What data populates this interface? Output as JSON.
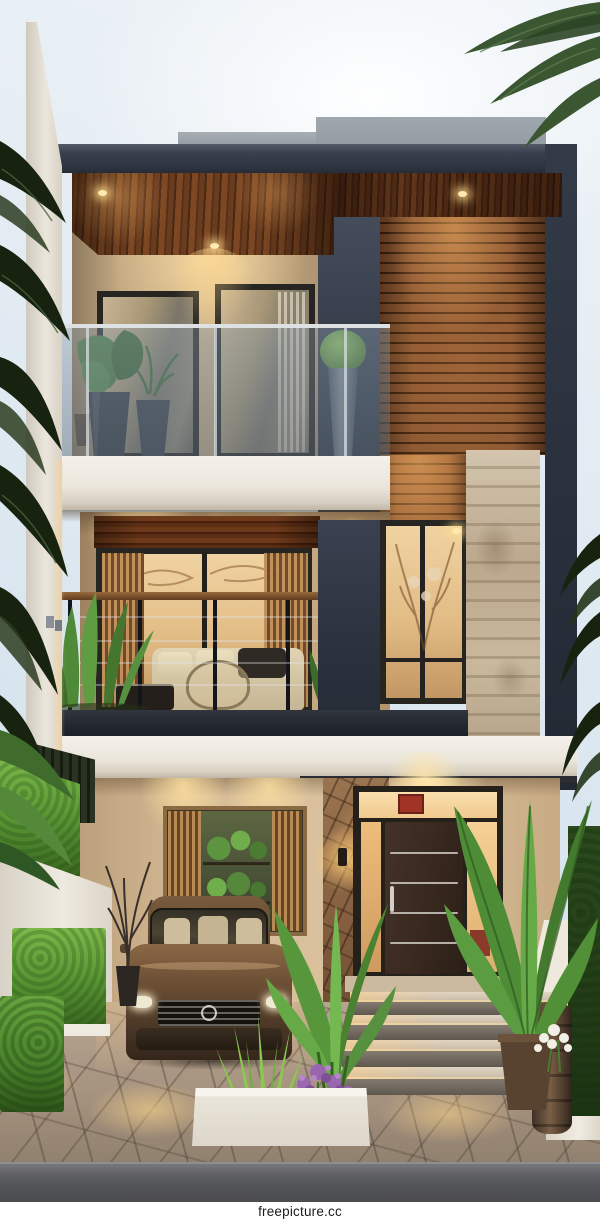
{
  "watermark": {
    "text": "freepicture.cc"
  },
  "scene": {
    "type": "architectural-photo",
    "time_of_day": "dusk with warm interior lighting",
    "description": "Modern minimalist three-story tropical house: dark flat roof fascia over a wood-plank soffit with downlights, glass-railed balcony with potted plants, horizontal wood-slat accent wall, travertine stone column, second-floor balcony with sofa and cable railing, tall warm-lit bedroom window, carport with a bronze sedan, plant-filled display window, stone entry pillar with sconce, dark wood entry door with steel inlays, lit entry steps, hedges, tropical plants, purple flowers, white planters, flagstone driveway and palms framing a pale sky.",
    "palette": {
      "sky": "#e3ecf3",
      "roof_fascia": "#39414d",
      "ceiling_wood": "#6a3c1d",
      "slat_wood": "#8a5632",
      "facade_beige": "#d8c19e",
      "dark_panel": "#363d4b",
      "stone_column": "#c4b59e",
      "entry_stone": "#8a6343",
      "white_slab": "#eceade",
      "interior_glow": "#f3cf97",
      "door_brown": "#3b2b21",
      "car_bronze": "#6e5138",
      "foliage_dark": "#17220f",
      "foliage_bright": "#6fae3f",
      "flower_purple": "#9a66b0",
      "paving": "#a89685",
      "road": "#55565a"
    },
    "elements": [
      "sky",
      "palm fronds",
      "rooftop boxes",
      "dark roof fascia",
      "wood soffit with downlights",
      "upper balcony with glass railing and plants",
      "wood slat accent wall",
      "stone column",
      "middle balcony with sofa",
      "tall bedroom window",
      "carport with bronze sedan",
      "plant display window",
      "entry stone pillar with sconce",
      "dark entry door with steel inlays",
      "entry steps",
      "hedge boxes",
      "tropical plants",
      "purple flowers",
      "white planter boxes",
      "flagstone driveway",
      "road",
      "watermark"
    ]
  }
}
